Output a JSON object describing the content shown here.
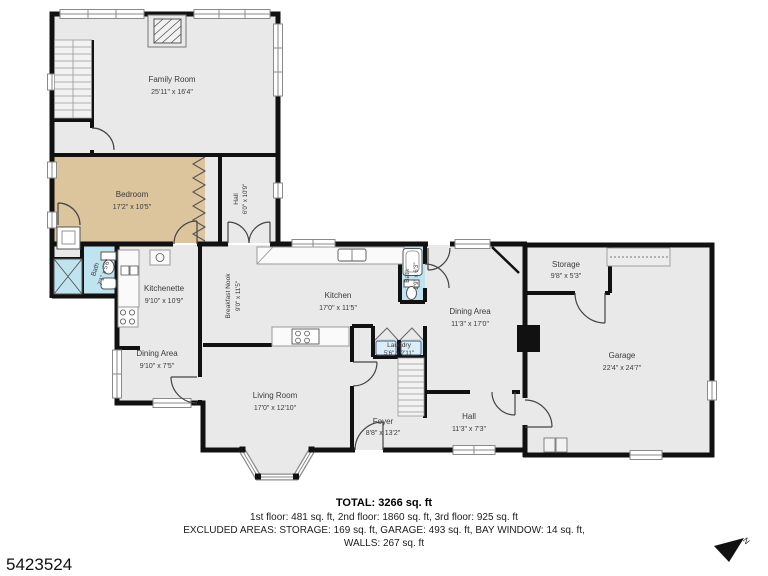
{
  "plan": {
    "rooms": {
      "family_room": {
        "name": "Family Room",
        "dims": "25'11\" x 16'4\""
      },
      "bedroom": {
        "name": "Bedroom",
        "dims": "17'2\" x 10'5\""
      },
      "hall_upper": {
        "name": "Hall",
        "dims": "6'0\" x 10'9\""
      },
      "bath_upper": {
        "name": "Bath",
        "dims": "7'1\" x 5'6\""
      },
      "kitchenette": {
        "name": "Kitchenette",
        "dims": "9'10\" x 10'9\""
      },
      "breakfast_nook": {
        "name": "Breakfast Nook",
        "dims": "9'0\" x 11'5\""
      },
      "kitchen": {
        "name": "Kitchen",
        "dims": "17'0\" x 11'5\""
      },
      "bath_main": {
        "name": "Bath",
        "dims": "2'9\" x 6'3\""
      },
      "dining_area_right": {
        "name": "Dining Area",
        "dims": "11'3\" x 17'0\""
      },
      "storage": {
        "name": "Storage",
        "dims": "9'8\" x 5'3\""
      },
      "garage": {
        "name": "Garage",
        "dims": "22'4\" x 24'7\""
      },
      "dining_area_left": {
        "name": "Dining Area",
        "dims": "9'10\" x 7'5\""
      },
      "living_room": {
        "name": "Living Room",
        "dims": "17'0\" x 12'10\""
      },
      "laundry": {
        "name": "Laundry",
        "dims": "5'6\" x 2'11\""
      },
      "foyer": {
        "name": "Foyer",
        "dims": "8'8\" x 13'2\""
      },
      "hall_lower": {
        "name": "Hall",
        "dims": "11'3\" x 7'3\""
      }
    },
    "summary": {
      "total": "TOTAL: 3266 sq. ft",
      "floors": "1st floor: 481 sq. ft, 2nd floor: 1860 sq. ft, 3rd floor: 925 sq. ft",
      "excluded": "EXCLUDED AREAS: STORAGE: 169 sq. ft, GARAGE: 493 sq. ft, BAY WINDOW: 14 sq. ft,",
      "walls": "WALLS: 267 sq. ft"
    },
    "listing_id": "5423524",
    "compass": "N",
    "colors": {
      "floor": "#e9e9e9",
      "bedroom_floor": "#dcc49c",
      "wet_room_floor": "#bfe4f0",
      "wall": "#111111",
      "text": "#3b3b3b"
    }
  }
}
